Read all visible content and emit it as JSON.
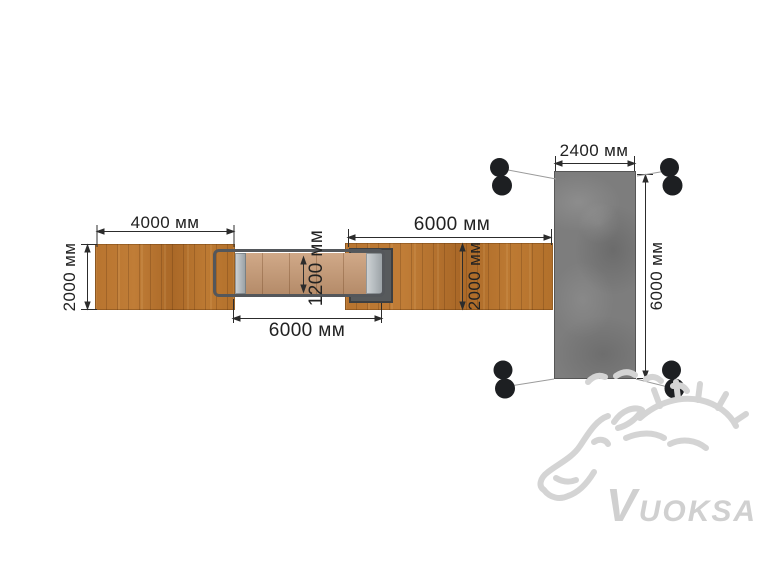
{
  "labels": {
    "left_platform_length": "4000 мм",
    "left_platform_width": "2000 мм",
    "bridge_width": "1200 мм",
    "bridge_span": "6000 мм",
    "right_platform_length": "6000 мм",
    "right_platform_width": "2000 мм",
    "end_platform_width": "2400 мм",
    "end_platform_length": "6000 мм"
  },
  "units": "мм",
  "watermark": {
    "text": "VUOKSA"
  },
  "colors": {
    "background": "#ffffff",
    "wood": "#b5712c",
    "bridge_deck_wood": "#c99b75",
    "bridge_frame": "#54575b",
    "metal_cap": "#b6bcc0",
    "support_platform": "#575a5c",
    "concrete": "#7d7d7d",
    "dimension_ink": "#222222",
    "mount_dot": "#1d1f22",
    "connector_line": "#9b9b9b",
    "watermark": "#d0d0d0"
  }
}
